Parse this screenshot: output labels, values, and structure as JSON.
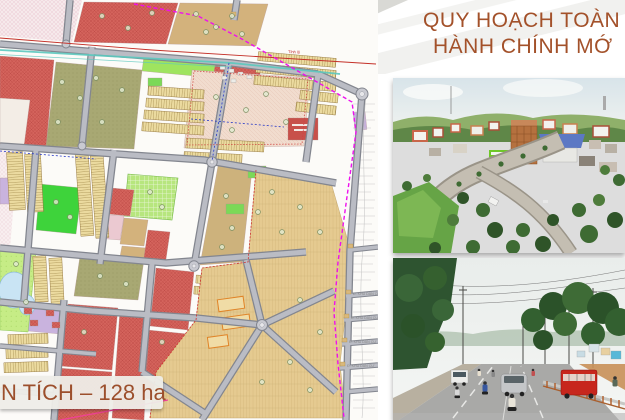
{
  "slide": {
    "title": {
      "line1": "QUY HOẠCH TOÀN K",
      "line2": "HÀNH CHÍNH MỚ"
    },
    "area_banner": {
      "text": "N TÍCH – 128 ha"
    }
  },
  "map": {
    "type": "urban-master-plan",
    "road_label_top": "Tỉnh lộ",
    "edge_road_labels": [
      "Đ. KHU DÂN CƯ",
      "Đ. KHU DÂN CƯ",
      "Đ. KHU DÂN CƯ",
      "Đ. KHU DÂN CƯ"
    ],
    "palette": {
      "residential_red": "#D4635C",
      "land_tan": "#D3B27C",
      "cadastral_tan": "#E5CA90",
      "park_green": "#3ED33B",
      "lot_stripe_yellow": "#EBDA9F",
      "water_blue": "#C9E4F4",
      "boundary_magenta": "#EE10EE",
      "accent_teal": "#5BC8BE",
      "road_gray": "#BABCC4"
    }
  },
  "photos": {
    "photo1": {
      "alt": "aerial-town-view"
    },
    "photo2": {
      "alt": "street-traffic-view"
    }
  },
  "colors": {
    "title_brown": "#A3512A",
    "banner_bg": "#EEEDE8"
  }
}
